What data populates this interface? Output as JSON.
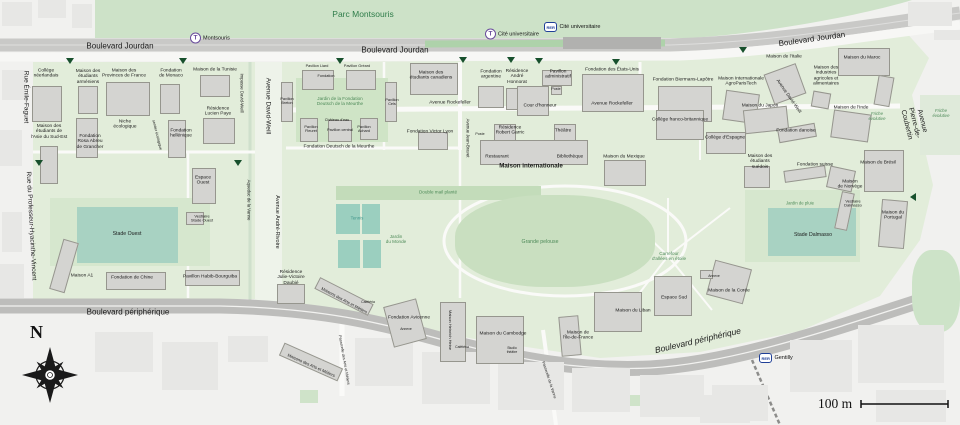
{
  "colors": {
    "city_bg": "#f1f1ef",
    "park_green": "#cde2c8",
    "campus_green": "#e2edda",
    "lawn_green": "#cfe4c6",
    "field_teal": "#a8d2c2",
    "court_teal": "#9bcfbf",
    "building_gray": "#d4d4d1",
    "road_gray": "#bdbdbb",
    "rail_gray": "#c9c9c7",
    "label_green": "#4d8a58",
    "tram_purple": "#6a4c9c",
    "rer_blue": "#1f3f97",
    "entrance_marker_green": "#17502c"
  },
  "compass": {
    "north_label": "N"
  },
  "scale_bar": {
    "label": "100 m"
  },
  "station_glyphs": {
    "tram": "T",
    "rer": "RER"
  },
  "stations": [
    {
      "type": "tram",
      "label": "Montsouris",
      "x": 190,
      "y": 38
    },
    {
      "type": "tram",
      "label": "Cité universitaire",
      "x": 485,
      "y": 34
    },
    {
      "type": "rer",
      "label": "Cité universitaire",
      "x": 544,
      "y": 27
    },
    {
      "type": "rer",
      "label": "Gentilly",
      "x": 759,
      "y": 358
    }
  ],
  "entrance_markers": [
    {
      "x": 70,
      "y": 61
    },
    {
      "x": 183,
      "y": 61
    },
    {
      "x": 340,
      "y": 61
    },
    {
      "x": 463,
      "y": 60
    },
    {
      "x": 511,
      "y": 60
    },
    {
      "x": 539,
      "y": 61
    },
    {
      "x": 616,
      "y": 62
    },
    {
      "x": 743,
      "y": 50
    },
    {
      "x": 39,
      "y": 163
    },
    {
      "x": 238,
      "y": 163
    },
    {
      "x": 913,
      "y": 197,
      "d": "left"
    }
  ],
  "labels": [
    {
      "t": "Parc Montsouris",
      "x": 363,
      "y": 15,
      "s": 8.5,
      "c": "park"
    },
    {
      "t": "Boulevard Jourdan",
      "x": 120,
      "y": 47,
      "s": 8
    },
    {
      "t": "Boulevard Jourdan",
      "x": 395,
      "y": 51,
      "s": 8
    },
    {
      "t": "Boulevard Jourdan",
      "x": 812,
      "y": 40,
      "s": 8,
      "r": -8
    },
    {
      "t": "Rue Émile-Faguet",
      "x": 26,
      "y": 97,
      "s": 6.5,
      "r": 90
    },
    {
      "t": "Rue du Professeur-Hyacinthe-Vincent",
      "x": 31,
      "y": 226,
      "s": 6.5,
      "r": 87
    },
    {
      "t": "Impasse David-Weill",
      "x": 241,
      "y": 93,
      "s": 4.3,
      "r": 90
    },
    {
      "t": "Avenue David-Weill",
      "x": 268,
      "y": 106,
      "s": 6.5,
      "r": 90
    },
    {
      "t": "Avenue André-Rivoire",
      "x": 277,
      "y": 222,
      "s": 5.5,
      "r": 90
    },
    {
      "t": "Aqueduc de la Vanne",
      "x": 248,
      "y": 200,
      "s": 4.3,
      "r": 90
    },
    {
      "t": "Avenue Rockefeller",
      "x": 450,
      "y": 103,
      "s": 4.8
    },
    {
      "t": "Avenue Rockefeller",
      "x": 612,
      "y": 104,
      "s": 4.8
    },
    {
      "t": "Avenue Jean-Bravet",
      "x": 467,
      "y": 138,
      "s": 4.3,
      "r": 90
    },
    {
      "t": "Avenue Pierre-de-Coubertin",
      "x": 914,
      "y": 123,
      "s": 7,
      "r": 76
    },
    {
      "t": "Avenue David-Weill",
      "x": 789,
      "y": 96,
      "s": 4.6,
      "r": 55
    },
    {
      "t": "Boulevard périphérique",
      "x": 128,
      "y": 313,
      "s": 8
    },
    {
      "t": "Boulevard périphérique",
      "x": 698,
      "y": 341,
      "s": 8.5,
      "r": -13,
      "i": 1
    },
    {
      "t": "Passerelle des Arts et Métiers",
      "x": 344,
      "y": 360,
      "s": 3.8,
      "r": 80
    },
    {
      "t": "Passerelle de la Vanne",
      "x": 549,
      "y": 380,
      "s": 3.8,
      "r": 72
    },
    {
      "t": "Jardin de la Fondation\nDeutsch de la Meurthe",
      "x": 340,
      "y": 101,
      "s": 4.6,
      "c": "gr"
    },
    {
      "t": "Jardin\ndu Monde",
      "x": 396,
      "y": 239,
      "s": 4.6,
      "c": "gr"
    },
    {
      "t": "Double mail planté",
      "x": 438,
      "y": 192,
      "s": 4.6,
      "c": "gr"
    },
    {
      "t": "Grande pelouse",
      "x": 540,
      "y": 243,
      "s": 5.2,
      "c": "gr"
    },
    {
      "t": "Carrefour\nd'allées en étoile",
      "x": 669,
      "y": 256,
      "s": 4.6,
      "c": "gr"
    },
    {
      "t": "Jardin de pluie",
      "x": 800,
      "y": 204,
      "s": 4.3,
      "c": "gr"
    },
    {
      "t": "Friche\névolutive",
      "x": 877,
      "y": 117,
      "s": 4.3,
      "c": "gr",
      "i": 1
    },
    {
      "t": "Friche\névolutive",
      "x": 941,
      "y": 114,
      "s": 4.3,
      "c": "gr",
      "i": 1
    },
    {
      "t": "sentier écologique",
      "x": 157,
      "y": 135,
      "s": 3.8,
      "r": 76
    },
    {
      "t": "Cour d'honneur",
      "x": 540,
      "y": 106,
      "s": 4.8
    },
    {
      "t": "Tennis",
      "x": 357,
      "y": 219,
      "s": 4.4,
      "c": "tl"
    },
    {
      "t": "Stade Ouest",
      "x": 127,
      "y": 235,
      "s": 5.2
    },
    {
      "t": "Stade Dalmasso",
      "x": 813,
      "y": 236,
      "s": 5.2
    },
    {
      "t": "Espace\nOuest",
      "x": 203,
      "y": 181,
      "s": 4.8
    },
    {
      "t": "Vestiaire\nStade Ouest",
      "x": 202,
      "y": 219,
      "s": 4
    },
    {
      "t": "Vestiaire\nDalmasso",
      "x": 853,
      "y": 204,
      "s": 4
    },
    {
      "t": "Espace Sud",
      "x": 674,
      "y": 298,
      "s": 4.8
    },
    {
      "t": "Niche\nécologique",
      "x": 125,
      "y": 125,
      "s": 4.8
    },
    {
      "t": "Collège\nnéerlandais",
      "x": 46,
      "y": 74
    },
    {
      "t": "Maison des\nétudiants\narméniens",
      "x": 88,
      "y": 77
    },
    {
      "t": "Maison des\nProvinces de France",
      "x": 124,
      "y": 74
    },
    {
      "t": "Fondation\nde Monaco",
      "x": 171,
      "y": 74
    },
    {
      "t": "Maison de la Tunisie",
      "x": 215,
      "y": 70
    },
    {
      "t": "Résidence\nLucien Paye",
      "x": 218,
      "y": 112
    },
    {
      "t": "Maison des\nétudiants de\nl'Asie du Sud-Est",
      "x": 49,
      "y": 132
    },
    {
      "t": "Fondation\nRosa Abreu\nde Grancher",
      "x": 90,
      "y": 142
    },
    {
      "t": "Fondation\nhellénique",
      "x": 181,
      "y": 134
    },
    {
      "t": "Maison A1",
      "x": 82,
      "y": 276
    },
    {
      "t": "Fondation de Chine",
      "x": 132,
      "y": 278
    },
    {
      "t": "Pavillon Habib-Bourguiba",
      "x": 210,
      "y": 277
    },
    {
      "t": "Pavillon Liard",
      "x": 317,
      "y": 66,
      "s": 3.8
    },
    {
      "t": "Fondation",
      "x": 326,
      "y": 76,
      "s": 3.8
    },
    {
      "t": "Pavillon Gréard",
      "x": 357,
      "y": 66,
      "s": 3.8
    },
    {
      "t": "Pavillon\nBreton",
      "x": 287,
      "y": 101,
      "s": 3.8
    },
    {
      "t": "Pavillon\nCels",
      "x": 392,
      "y": 102,
      "s": 3.8
    },
    {
      "t": "Château d'eau",
      "x": 337,
      "y": 120,
      "s": 3.8
    },
    {
      "t": "Pavillon central",
      "x": 340,
      "y": 130,
      "s": 3.8
    },
    {
      "t": "Pavillon\nFleuret",
      "x": 311,
      "y": 129,
      "s": 3.8
    },
    {
      "t": "Pavillon\nAchard",
      "x": 364,
      "y": 129,
      "s": 3.8
    },
    {
      "t": "Fondation Deutsch de la Meurthe",
      "x": 339,
      "y": 147,
      "s": 4.8
    },
    {
      "t": "Maison des\nétudiants canadiens",
      "x": 431,
      "y": 76
    },
    {
      "t": "Fondation Victor Lyon",
      "x": 430,
      "y": 132
    },
    {
      "t": "Poste",
      "x": 480,
      "y": 134,
      "s": 3.6
    },
    {
      "t": "Fondation\nargentine",
      "x": 491,
      "y": 75
    },
    {
      "t": "Résidence\nAndré\nHonnorat",
      "x": 517,
      "y": 77
    },
    {
      "t": "Pavillon\nadministratif",
      "x": 558,
      "y": 75
    },
    {
      "t": "Poste",
      "x": 556,
      "y": 89,
      "s": 3.6
    },
    {
      "t": "Fondation des États-Unis",
      "x": 612,
      "y": 70
    },
    {
      "t": "Fondation Biermans-Lapôtre",
      "x": 683,
      "y": 80
    },
    {
      "t": "Maison Internationale\nAgroParisTech",
      "x": 741,
      "y": 82
    },
    {
      "t": "Maison de l'Italie",
      "x": 784,
      "y": 57
    },
    {
      "t": "Maison du Maroc",
      "x": 862,
      "y": 58
    },
    {
      "t": "Maison des\nIndustries\nagricoles et\nalimentaires",
      "x": 826,
      "y": 76
    },
    {
      "t": "Maison du Japon",
      "x": 760,
      "y": 106
    },
    {
      "t": "Collège franco-britannique",
      "x": 680,
      "y": 120
    },
    {
      "t": "Collège d'Espagne",
      "x": 725,
      "y": 138
    },
    {
      "t": "Fondation danoise",
      "x": 796,
      "y": 131
    },
    {
      "t": "Maison de l'Inde",
      "x": 851,
      "y": 108
    },
    {
      "t": "Fondation suisse",
      "x": 815,
      "y": 165
    },
    {
      "t": "Maison du Brésil",
      "x": 878,
      "y": 163
    },
    {
      "t": "Maison des\nétudiants\nsuédois",
      "x": 760,
      "y": 162
    },
    {
      "t": "Maison du Mexique",
      "x": 624,
      "y": 157
    },
    {
      "t": "Restaurant",
      "x": 497,
      "y": 157
    },
    {
      "t": "Bibliothèque",
      "x": 570,
      "y": 157
    },
    {
      "t": "Maison internationale",
      "x": 531,
      "y": 167,
      "s": 6.2,
      "b": 1
    },
    {
      "t": "Résidence\nRobert Garric",
      "x": 510,
      "y": 131
    },
    {
      "t": "Théâtre",
      "x": 563,
      "y": 131
    },
    {
      "t": "Maison du\nPortugal",
      "x": 893,
      "y": 216
    },
    {
      "t": "Maison\nde Norvège",
      "x": 850,
      "y": 185
    },
    {
      "t": "Maison du Liban",
      "x": 633,
      "y": 311
    },
    {
      "t": "Maison de la Corée",
      "x": 729,
      "y": 291
    },
    {
      "t": "Annexe",
      "x": 714,
      "y": 277,
      "s": 3.4
    },
    {
      "t": "Maisons des Arts et Métiers",
      "x": 344,
      "y": 301,
      "s": 4.2,
      "r": 28
    },
    {
      "t": "Maisons des Arts et Métiers",
      "x": 311,
      "y": 366,
      "s": 4.2,
      "r": 24
    },
    {
      "t": "Cafétéria",
      "x": 368,
      "y": 303,
      "s": 3.4
    },
    {
      "t": "Fondation Avicenne",
      "x": 409,
      "y": 318
    },
    {
      "t": "Annexe",
      "x": 406,
      "y": 330,
      "s": 3.4
    },
    {
      "t": "Maison Heinrich Heine",
      "x": 450,
      "y": 330,
      "s": 4,
      "r": 90
    },
    {
      "t": "Cafétéria",
      "x": 462,
      "y": 348,
      "s": 3.4
    },
    {
      "t": "Maison du Cambodge",
      "x": 503,
      "y": 334
    },
    {
      "t": "Studio\nthéâtre",
      "x": 512,
      "y": 351,
      "s": 3.4
    },
    {
      "t": "Maison de\nl'Île-de-France",
      "x": 578,
      "y": 336
    },
    {
      "t": "Résidence\nJulie-Victoire\nDaubié",
      "x": 291,
      "y": 278
    }
  ],
  "buildings": [
    [
      32,
      86,
      30,
      36
    ],
    [
      78,
      86,
      20,
      28
    ],
    [
      106,
      82,
      44,
      34
    ],
    [
      160,
      84,
      20,
      30
    ],
    [
      200,
      75,
      30,
      22
    ],
    [
      203,
      118,
      32,
      26
    ],
    [
      40,
      146,
      18,
      38
    ],
    [
      76,
      118,
      22,
      40
    ],
    [
      168,
      120,
      18,
      38
    ],
    [
      192,
      168,
      24,
      36
    ],
    [
      186,
      212,
      18,
      13
    ],
    [
      56,
      240,
      16,
      52,
      16
    ],
    [
      106,
      272,
      60,
      18
    ],
    [
      185,
      270,
      55,
      16
    ],
    [
      302,
      70,
      32,
      20
    ],
    [
      346,
      70,
      30,
      20
    ],
    [
      281,
      82,
      12,
      40
    ],
    [
      385,
      82,
      12,
      40
    ],
    [
      300,
      118,
      18,
      24
    ],
    [
      360,
      118,
      18,
      22
    ],
    [
      328,
      120,
      24,
      22
    ],
    [
      410,
      63,
      48,
      32
    ],
    [
      418,
      132,
      30,
      18
    ],
    [
      478,
      86,
      26,
      22
    ],
    [
      506,
      88,
      24,
      22
    ],
    [
      542,
      70,
      30,
      16
    ],
    [
      551,
      86,
      11,
      9
    ],
    [
      582,
      74,
      62,
      38
    ],
    [
      658,
      86,
      54,
      36
    ],
    [
      724,
      92,
      34,
      30,
      8
    ],
    [
      768,
      68,
      34,
      32,
      -20
    ],
    [
      838,
      48,
      52,
      28
    ],
    [
      876,
      76,
      16,
      30,
      10
    ],
    [
      812,
      92,
      18,
      16,
      10
    ],
    [
      744,
      108,
      44,
      24,
      -6
    ],
    [
      656,
      110,
      48,
      30
    ],
    [
      706,
      132,
      40,
      22
    ],
    [
      778,
      126,
      38,
      14,
      -10
    ],
    [
      832,
      112,
      38,
      28,
      8
    ],
    [
      604,
      160,
      42,
      26
    ],
    [
      744,
      166,
      26,
      22
    ],
    [
      784,
      168,
      42,
      12,
      -8
    ],
    [
      828,
      168,
      26,
      22,
      12
    ],
    [
      864,
      150,
      40,
      42
    ],
    [
      880,
      200,
      26,
      48,
      5
    ],
    [
      838,
      192,
      13,
      38,
      12
    ],
    [
      517,
      86,
      32,
      30
    ],
    [
      494,
      124,
      22,
      18
    ],
    [
      554,
      124,
      22,
      18
    ],
    [
      480,
      140,
      108,
      25
    ],
    [
      277,
      284,
      28,
      20
    ],
    [
      314,
      290,
      60,
      13,
      27
    ],
    [
      279,
      355,
      64,
      14,
      24
    ],
    [
      388,
      302,
      34,
      42,
      -15
    ],
    [
      440,
      302,
      26,
      60
    ],
    [
      476,
      316,
      48,
      48
    ],
    [
      560,
      316,
      20,
      40,
      -5
    ],
    [
      594,
      292,
      48,
      40
    ],
    [
      710,
      264,
      38,
      36,
      15
    ],
    [
      654,
      276,
      38,
      40
    ],
    [
      700,
      270,
      13,
      9
    ]
  ],
  "city_blocks": [
    [
      2,
      2,
      30,
      24
    ],
    [
      38,
      0,
      28,
      18
    ],
    [
      72,
      4,
      20,
      24
    ],
    [
      908,
      2,
      44,
      24
    ],
    [
      934,
      30,
      26,
      10
    ],
    [
      2,
      70,
      24,
      30
    ],
    [
      0,
      130,
      22,
      36
    ],
    [
      2,
      212,
      20,
      40
    ],
    [
      0,
      264,
      24,
      34
    ],
    [
      95,
      332,
      58,
      40
    ],
    [
      162,
      342,
      56,
      48
    ],
    [
      228,
      336,
      40,
      26
    ],
    [
      355,
      338,
      58,
      48
    ],
    [
      422,
      352,
      68,
      52
    ],
    [
      498,
      362,
      66,
      48
    ],
    [
      572,
      368,
      58,
      44
    ],
    [
      640,
      375,
      64,
      42
    ],
    [
      712,
      385,
      56,
      36
    ],
    [
      790,
      340,
      62,
      52
    ],
    [
      858,
      325,
      86,
      58
    ],
    [
      876,
      390,
      70,
      32
    ],
    [
      700,
      395,
      50,
      28
    ]
  ],
  "green_patches": [
    {
      "x": 296,
      "y": 78,
      "w": 92,
      "h": 64,
      "c": "#cfe4c6"
    },
    {
      "x": 50,
      "y": 198,
      "w": 160,
      "h": 68,
      "c": "#d6e7ce"
    },
    {
      "x": 77,
      "y": 207,
      "w": 101,
      "h": 56,
      "c": "#a8d2c2"
    },
    {
      "x": 336,
      "y": 186,
      "w": 205,
      "h": 14,
      "c": "#c3dcba"
    },
    {
      "x": 455,
      "y": 195,
      "w": 200,
      "h": 92,
      "c": "#c9dfc0",
      "rad": 45
    },
    {
      "x": 336,
      "y": 204,
      "w": 24,
      "h": 30,
      "c": "#9bcfbf"
    },
    {
      "x": 362,
      "y": 204,
      "w": 18,
      "h": 30,
      "c": "#9bcfbf"
    },
    {
      "x": 338,
      "y": 240,
      "w": 22,
      "h": 28,
      "c": "#9bcfbf"
    },
    {
      "x": 363,
      "y": 240,
      "w": 18,
      "h": 28,
      "c": "#9bcfbf"
    },
    {
      "x": 745,
      "y": 190,
      "w": 115,
      "h": 72,
      "c": "#d6e7ce"
    },
    {
      "x": 768,
      "y": 208,
      "w": 88,
      "h": 48,
      "c": "#a8d2c2"
    },
    {
      "x": 920,
      "y": 95,
      "w": 40,
      "h": 60,
      "c": "#dfeada"
    },
    {
      "x": 912,
      "y": 250,
      "w": 48,
      "h": 82,
      "c": "#cde3c8",
      "rad": 40
    },
    {
      "x": 120,
      "y": 336,
      "w": 16,
      "h": 12,
      "c": "#cfe3c9"
    },
    {
      "x": 300,
      "y": 390,
      "w": 18,
      "h": 13,
      "c": "#cfe3c9"
    },
    {
      "x": 455,
      "y": 390,
      "w": 14,
      "h": 10,
      "c": "#cfe3c9"
    },
    {
      "x": 628,
      "y": 395,
      "w": 15,
      "h": 11,
      "c": "#cfe3c9"
    }
  ]
}
